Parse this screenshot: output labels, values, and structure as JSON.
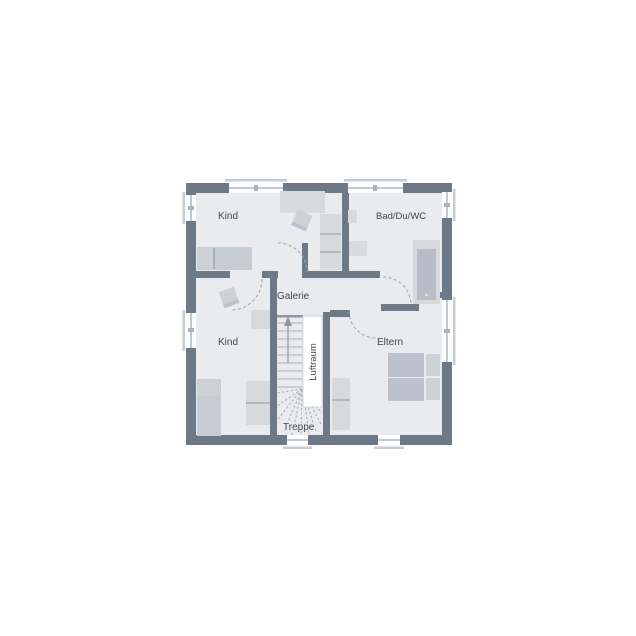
{
  "rooms": {
    "kind_top": {
      "label": "Kind"
    },
    "bad": {
      "label": "Bad/Du/WC"
    },
    "galerie": {
      "label": "Galerie"
    },
    "kind_bottom": {
      "label": "Kind"
    },
    "eltern": {
      "label": "Eltern"
    }
  },
  "stairs": {
    "label": "Treppe",
    "direction_icon": "stairs-up-arrow"
  },
  "void": {
    "label": "Luftraum"
  },
  "colors": {
    "background": "#ffffff",
    "wall": "#6e7987",
    "floor": "#e9ebee",
    "furniture_light": "#d6dade",
    "furniture_mid": "#c6ccd3",
    "furniture_dark": "#bbc2cb",
    "pillow": "#cdd2d9",
    "fixture": "#d7dbe0",
    "tub_inner": "#b7bdc7",
    "tread_line": "#a9b0ba",
    "dash_line": "#9aa3ae",
    "sill": "#c8cdd4",
    "label_text": "#3e4754",
    "void_white": "#ffffff",
    "edge_line": "#8e98a4"
  }
}
